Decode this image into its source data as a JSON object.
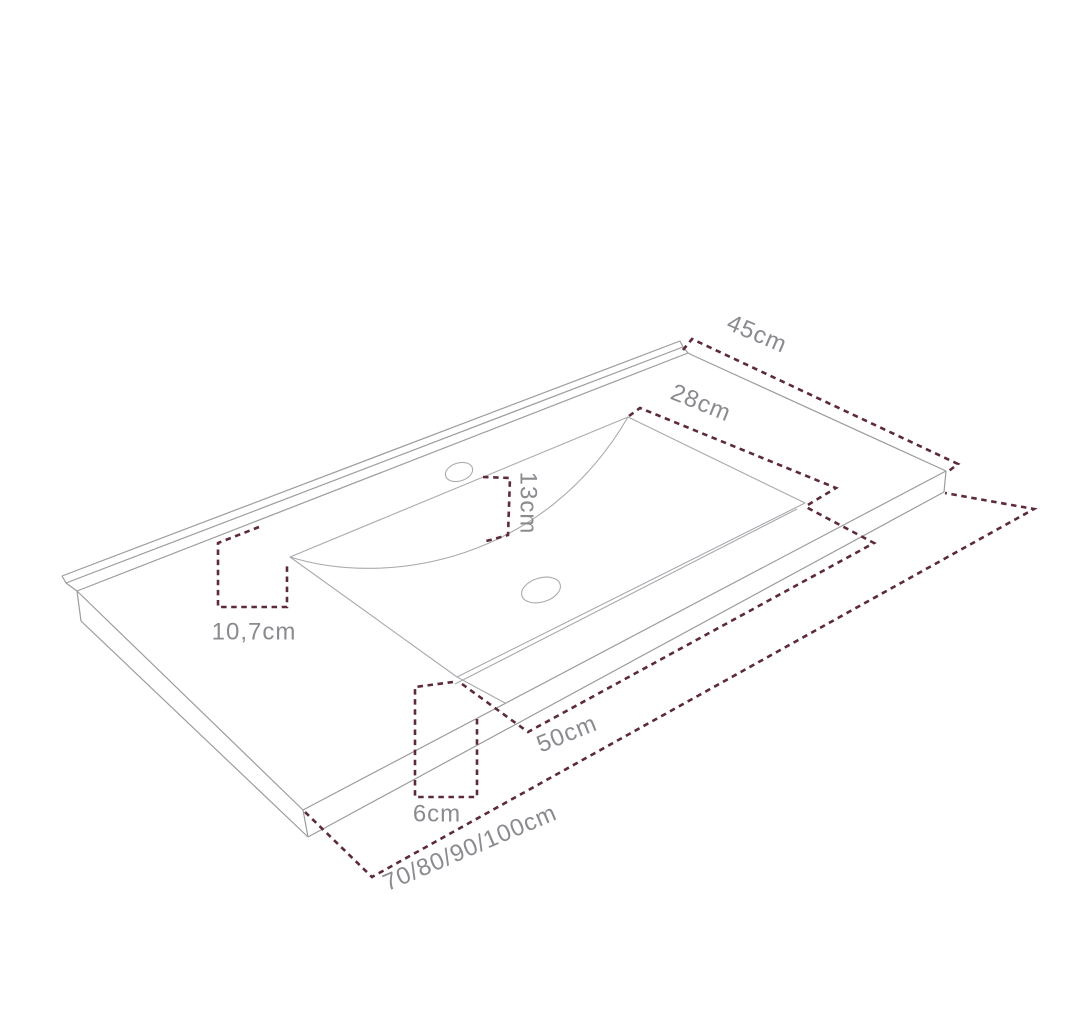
{
  "diagram": {
    "subject": "vanity-countertop-with-integrated-washbasin",
    "view": "isometric-technical-line-drawing",
    "background_color": "#ffffff",
    "line_color": "#9c9ca1",
    "line_color_light": "#aaaaaf",
    "dimension_color": "#5c2a3a",
    "label_color": "#8a8a8f",
    "dimensions": [
      {
        "id": "countertop-depth",
        "label": "45cm"
      },
      {
        "id": "basin-depth",
        "label": "28cm"
      },
      {
        "id": "basin-back-wall-height",
        "label": "13cm"
      },
      {
        "id": "back-edge-to-basin",
        "label": "10,7cm"
      },
      {
        "id": "basin-width",
        "label": "50cm"
      },
      {
        "id": "basin-to-front-edge",
        "label": "6cm"
      },
      {
        "id": "countertop-width-options",
        "label": "70/80/90/100cm"
      }
    ]
  }
}
